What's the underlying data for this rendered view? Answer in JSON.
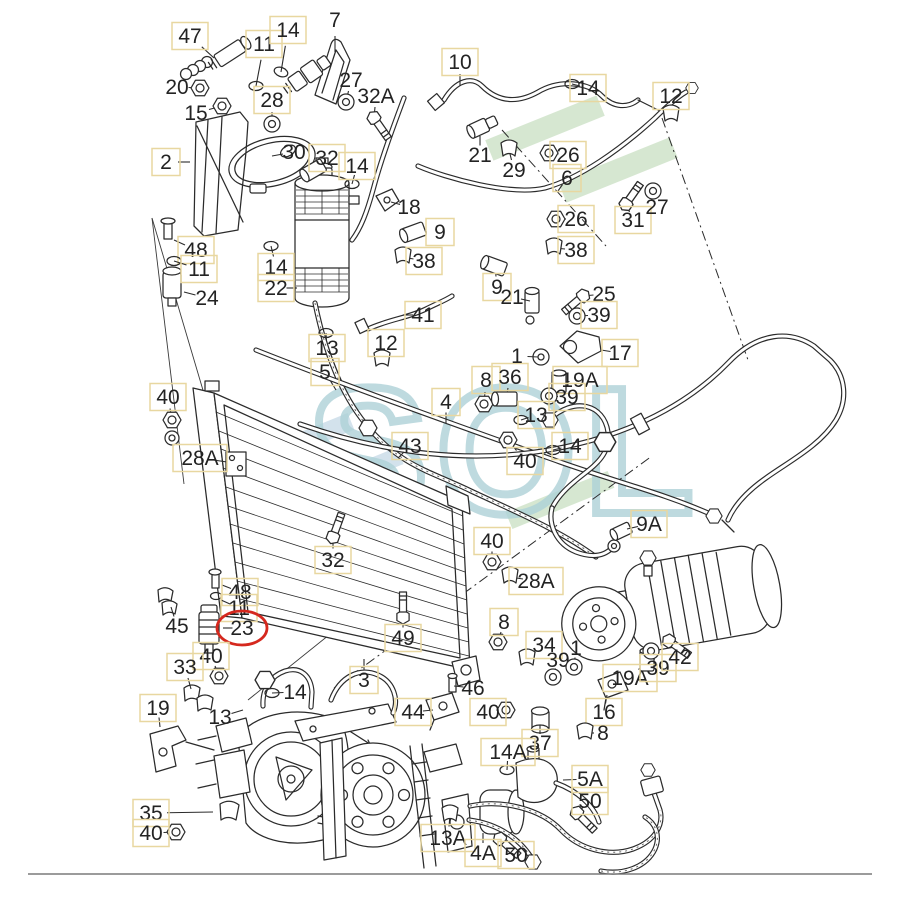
{
  "watermark": {
    "text": "SOL",
    "letter_color": "#aed2d8",
    "stripe_green": "#cfe3c9",
    "stripe_blue": "#cbdde9"
  },
  "diagram": {
    "type": "exploded-parts-diagram",
    "highlighted_part": "23",
    "highlight_color": "#d5281e",
    "box_color": "#e8d7a0",
    "line_color": "#2b2b2b",
    "label_fields": [
      "text",
      "x",
      "y",
      "boxed",
      "leader_x",
      "leader_y",
      "glyph",
      "glyph_rotation",
      "circled"
    ],
    "labels": [
      [
        "47",
        190,
        36,
        1,
        214,
        58,
        "none",
        0,
        0
      ],
      [
        "11",
        264,
        44,
        1,
        256,
        86,
        "oring",
        0,
        0
      ],
      [
        "14",
        288,
        30,
        1,
        281,
        72,
        "oring",
        20,
        0
      ],
      [
        "7",
        335,
        20,
        0,
        335,
        52,
        "none",
        0,
        0
      ],
      [
        "20",
        177,
        87,
        0,
        200,
        88,
        "nut",
        0,
        0
      ],
      [
        "15",
        196,
        113,
        0,
        222,
        106,
        "nut",
        0,
        0
      ],
      [
        "28",
        272,
        100,
        1,
        272,
        124,
        "washer",
        0,
        0
      ],
      [
        "27",
        351,
        80,
        0,
        346,
        102,
        "washer",
        0,
        0
      ],
      [
        "32A",
        376,
        96,
        0,
        374,
        118,
        "bolt",
        55,
        0
      ],
      [
        "2",
        166,
        162,
        1,
        190,
        162,
        "none",
        0,
        0
      ],
      [
        "30",
        294,
        152,
        0,
        272,
        156,
        "none",
        0,
        0
      ],
      [
        "32",
        327,
        158,
        1,
        314,
        170,
        "fitting",
        -30,
        0
      ],
      [
        "14",
        357,
        166,
        1,
        352,
        184,
        "oring",
        0,
        0
      ],
      [
        "10",
        460,
        62,
        1,
        460,
        86,
        "none",
        0,
        0
      ],
      [
        "21",
        480,
        155,
        0,
        480,
        136,
        "none",
        0,
        0
      ],
      [
        "29",
        514,
        170,
        0,
        509,
        150,
        "clip",
        0,
        0
      ],
      [
        "26",
        568,
        155,
        1,
        549,
        153,
        "nut",
        0,
        0
      ],
      [
        "14",
        588,
        88,
        1,
        572,
        84,
        "oring",
        0,
        0
      ],
      [
        "12",
        671,
        96,
        1,
        671,
        115,
        "clip",
        0,
        0
      ],
      [
        "6",
        567,
        178,
        1,
        558,
        191,
        "none",
        0,
        0
      ],
      [
        "26",
        576,
        219,
        1,
        556,
        219,
        "nut",
        0,
        0
      ],
      [
        "38",
        576,
        250,
        1,
        554,
        248,
        "clip",
        0,
        0
      ],
      [
        "31",
        633,
        220,
        1,
        626,
        204,
        "bolt",
        -55,
        0
      ],
      [
        "27",
        657,
        207,
        0,
        653,
        191,
        "washer",
        0,
        0
      ],
      [
        "18",
        409,
        207,
        0,
        391,
        202,
        "none",
        0,
        0
      ],
      [
        "9",
        440,
        232,
        1,
        414,
        232,
        "fitting",
        -20,
        0
      ],
      [
        "38",
        424,
        261,
        1,
        403,
        257,
        "clip",
        0,
        0
      ],
      [
        "9",
        497,
        287,
        1,
        495,
        266,
        "fitting",
        20,
        0
      ],
      [
        "21",
        512,
        297,
        0,
        530,
        301,
        "none",
        0,
        0
      ],
      [
        "25",
        604,
        294,
        0,
        583,
        296,
        "bolt",
        140,
        0
      ],
      [
        "39",
        599,
        315,
        1,
        577,
        316,
        "washer",
        0,
        0
      ],
      [
        "17",
        620,
        353,
        1,
        601,
        350,
        "none",
        0,
        0
      ],
      [
        "48",
        196,
        250,
        1,
        174,
        240,
        "none",
        0,
        0
      ],
      [
        "11",
        199,
        269,
        1,
        174,
        261,
        "oring",
        0,
        0
      ],
      [
        "24",
        207,
        298,
        0,
        184,
        292,
        "none",
        0,
        0
      ],
      [
        "14",
        276,
        267,
        1,
        271,
        246,
        "oring",
        0,
        0
      ],
      [
        "22",
        276,
        288,
        1,
        297,
        288,
        "none",
        0,
        0
      ],
      [
        "41",
        423,
        315,
        1,
        403,
        315,
        "none",
        0,
        0
      ],
      [
        "13",
        327,
        348,
        1,
        326,
        333,
        "oring",
        0,
        0
      ],
      [
        "12",
        386,
        343,
        1,
        382,
        360,
        "clip",
        0,
        0
      ],
      [
        "5",
        325,
        372,
        1,
        336,
        390,
        "none",
        0,
        0
      ],
      [
        "40",
        168,
        397,
        1,
        172,
        420,
        "nut",
        0,
        0
      ],
      [
        "28A",
        200,
        458,
        1,
        227,
        462,
        "none",
        0,
        0
      ],
      [
        "4",
        446,
        402,
        1,
        446,
        423,
        "none",
        0,
        0
      ],
      [
        "8",
        486,
        380,
        1,
        484,
        404,
        "nut",
        0,
        0
      ],
      [
        "36",
        510,
        377,
        1,
        506,
        399,
        "fitting",
        0,
        0
      ],
      [
        "1",
        517,
        356,
        0,
        538,
        357,
        "none",
        0,
        0
      ],
      [
        "19A",
        580,
        380,
        1,
        559,
        383,
        "cyl",
        0,
        0
      ],
      [
        "39",
        567,
        397,
        1,
        549,
        396,
        "washer",
        0,
        0
      ],
      [
        "13",
        536,
        415,
        1,
        521,
        420,
        "oring",
        0,
        0
      ],
      [
        "14",
        570,
        446,
        1,
        553,
        450,
        "oring",
        0,
        0
      ],
      [
        "40",
        525,
        461,
        1,
        508,
        440,
        "nut",
        0,
        0
      ],
      [
        "43",
        410,
        446,
        1,
        398,
        458,
        "none",
        0,
        0
      ],
      [
        "32",
        333,
        560,
        1,
        333,
        537,
        "bolt",
        -70,
        0
      ],
      [
        "9A",
        649,
        524,
        1,
        627,
        529,
        "none",
        0,
        0
      ],
      [
        "40",
        492,
        541,
        1,
        492,
        562,
        "nut",
        0,
        0
      ],
      [
        "28A",
        536,
        581,
        1,
        510,
        577,
        "clip",
        0,
        0
      ],
      [
        "48",
        240,
        592,
        1,
        222,
        585,
        "none",
        0,
        0
      ],
      [
        "11",
        239,
        608,
        1,
        221,
        600,
        "none",
        0,
        0
      ],
      [
        "23",
        242,
        628,
        0,
        223,
        628,
        "none",
        0,
        1
      ],
      [
        "45",
        177,
        626,
        0,
        171,
        607,
        "none",
        0,
        0
      ],
      [
        "40",
        211,
        656,
        1,
        219,
        676,
        "nut",
        0,
        0
      ],
      [
        "33",
        185,
        667,
        1,
        191,
        689,
        "none",
        0,
        0
      ],
      [
        "19",
        158,
        708,
        1,
        160,
        727,
        "none",
        0,
        0
      ],
      [
        "13",
        220,
        717,
        0,
        243,
        710,
        "none",
        0,
        0
      ],
      [
        "14",
        295,
        692,
        0,
        272,
        693,
        "oring",
        0,
        0
      ],
      [
        "3",
        364,
        680,
        1,
        364,
        659,
        "none",
        0,
        0
      ],
      [
        "49",
        403,
        638,
        1,
        403,
        617,
        "bolt",
        -90,
        0
      ],
      [
        "8",
        504,
        622,
        1,
        498,
        642,
        "nut",
        0,
        0
      ],
      [
        "34",
        544,
        645,
        1,
        527,
        659,
        "clip",
        0,
        0
      ],
      [
        "39",
        558,
        660,
        0,
        553,
        677,
        "washer",
        0,
        0
      ],
      [
        "1",
        576,
        648,
        0,
        574,
        667,
        "washer",
        0,
        0
      ],
      [
        "19A",
        630,
        678,
        1,
        647,
        661,
        "cyl",
        0,
        0
      ],
      [
        "16",
        604,
        712,
        1,
        607,
        695,
        "none",
        0,
        0
      ],
      [
        "8",
        603,
        733,
        0,
        585,
        733,
        "clip",
        0,
        0
      ],
      [
        "39",
        658,
        668,
        1,
        651,
        651,
        "washer",
        0,
        0
      ],
      [
        "42",
        680,
        657,
        1,
        669,
        641,
        "bolt",
        35,
        0
      ],
      [
        "46",
        473,
        688,
        0,
        454,
        686,
        "none",
        0,
        0
      ],
      [
        "44",
        413,
        712,
        1,
        433,
        710,
        "none",
        0,
        0
      ],
      [
        "40",
        488,
        712,
        1,
        506,
        710,
        "nut",
        0,
        0
      ],
      [
        "37",
        540,
        743,
        1,
        540,
        725,
        "none",
        0,
        0
      ],
      [
        "14A",
        508,
        752,
        1,
        507,
        770,
        "oring",
        0,
        0
      ],
      [
        "5A",
        590,
        779,
        1,
        563,
        780,
        "none",
        0,
        0
      ],
      [
        "50",
        590,
        801,
        1,
        577,
        813,
        "bolt",
        45,
        0
      ],
      [
        "50",
        516,
        855,
        1,
        500,
        839,
        "bolt",
        42,
        0
      ],
      [
        "13A",
        448,
        838,
        1,
        450,
        815,
        "clip",
        0,
        0
      ],
      [
        "4A",
        483,
        853,
        1,
        483,
        833,
        "none",
        0,
        0
      ],
      [
        "35",
        151,
        813,
        1,
        213,
        812,
        "none",
        0,
        0
      ],
      [
        "40",
        151,
        833,
        1,
        176,
        832,
        "nut",
        0,
        0
      ]
    ]
  }
}
